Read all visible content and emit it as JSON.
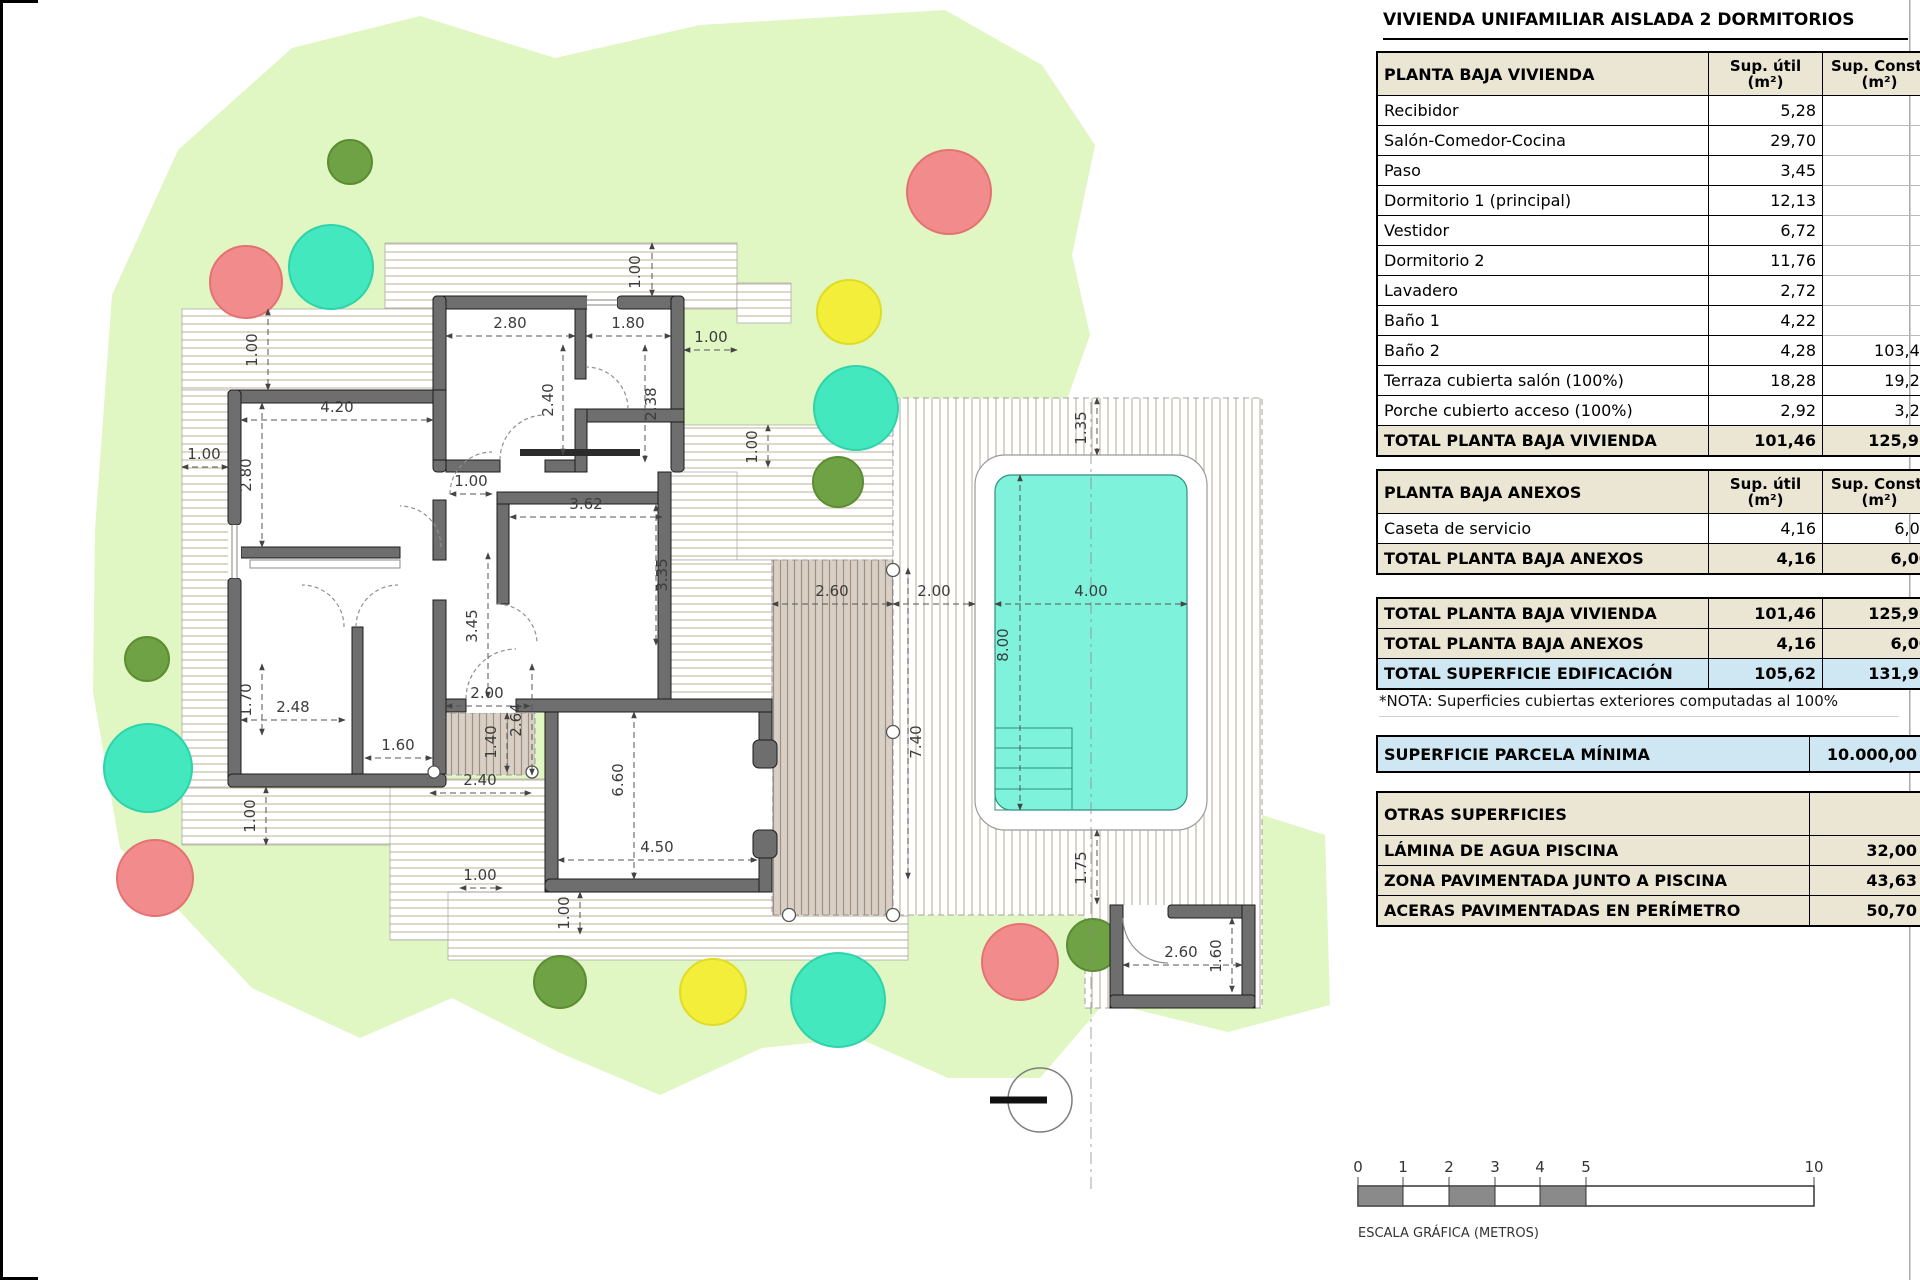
{
  "title": "VIVIENDA UNIFAMILIAR AISLADA 2 DORMITORIOS",
  "tables": {
    "vivienda": {
      "header": {
        "label": "PLANTA BAJA VIVIENDA",
        "util": "Sup. útil",
        "const": "Sup. Const.",
        "unit": "(m²)"
      },
      "rows": [
        {
          "label": "Recibidor",
          "util": "5,28",
          "const": ""
        },
        {
          "label": "Salón-Comedor-Cocina",
          "util": "29,70",
          "const": ""
        },
        {
          "label": "Paso",
          "util": "3,45",
          "const": ""
        },
        {
          "label": "Dormitorio 1 (principal)",
          "util": "12,13",
          "const": ""
        },
        {
          "label": "Vestidor",
          "util": "6,72",
          "const": ""
        },
        {
          "label": "Dormitorio 2",
          "util": "11,76",
          "const": ""
        },
        {
          "label": "Lavadero",
          "util": "2,72",
          "const": ""
        },
        {
          "label": "Baño 1",
          "util": "4,22",
          "const": ""
        },
        {
          "label": "Baño 2",
          "util": "4,28",
          "const": "103,44"
        },
        {
          "label": "Terraza cubierta salón (100%)",
          "util": "18,28",
          "const": "19,24"
        },
        {
          "label": "Porche cubierto acceso (100%)",
          "util": "2,92",
          "const": "3,24"
        }
      ],
      "total": {
        "label": "TOTAL PLANTA BAJA VIVIENDA",
        "util": "101,46",
        "const": "125,92"
      }
    },
    "anexos": {
      "header": {
        "label": "PLANTA BAJA ANEXOS",
        "util": "Sup. útil",
        "const": "Sup. Const.",
        "unit": "(m²)"
      },
      "rows": [
        {
          "label": "Caseta de servicio",
          "util": "4,16",
          "const": "6,00"
        }
      ],
      "total": {
        "label": "TOTAL PLANTA BAJA ANEXOS",
        "util": "4,16",
        "const": "6,00"
      }
    },
    "totales": [
      {
        "label": "TOTAL PLANTA BAJA VIVIENDA",
        "util": "101,46",
        "const": "125,92"
      },
      {
        "label": "TOTAL PLANTA BAJA ANEXOS",
        "util": "4,16",
        "const": "6,00"
      },
      {
        "label": "TOTAL SUPERFICIE EDIFICACIÓN",
        "util": "105,62",
        "const": "131,92"
      }
    ],
    "nota": "*NOTA: Superficies cubiertas exteriores computadas al 100%",
    "parcela": {
      "label": "SUPERFICIE PARCELA MÍNIMA",
      "value": "10.000,00"
    },
    "otras": {
      "header": "OTRAS SUPERFICIES",
      "rows": [
        {
          "label": "LÁMINA DE AGUA PISCINA",
          "value": "32,00"
        },
        {
          "label": "ZONA PAVIMENTADA JUNTO A PISCINA",
          "value": "43,63"
        },
        {
          "label": "ACERAS PAVIMENTADAS EN PERÍMETRO",
          "value": "50,70"
        }
      ]
    }
  },
  "scalebar": {
    "ticks": [
      "0",
      "1",
      "2",
      "3",
      "4",
      "5",
      "10"
    ],
    "label": "ESCALA GRÁFICA (METROS)"
  },
  "plan": {
    "dims": [
      "1.00",
      "2.80",
      "1.80",
      "1.00",
      "2.40",
      "2.38",
      "4.20",
      "2.80",
      "1.00",
      "1.00",
      "1.70",
      "2.48",
      "1.60",
      "1.00",
      "1.00",
      "3.45",
      "3.62",
      "3.35",
      "2.00",
      "2.64",
      "1.40",
      "2.40",
      "6.60",
      "4.50",
      "1.00",
      "1.00",
      "2.60",
      "2.00",
      "4.00",
      "8.00",
      "1.35",
      "1.75",
      "7.40",
      "1.00",
      "2.60",
      "1.60"
    ]
  },
  "colors": {
    "garden": "#e0f6c3",
    "pool": "#7ff2dc",
    "wall": "#6e6e6e",
    "tree_red": "#f28b8b",
    "tree_teal": "#43e8bf",
    "tree_yellow": "#f2ee3a",
    "tree_green": "#6fa244",
    "table_header_bg": "#eae6d3",
    "highlight_blue": "#cfe7f2"
  }
}
